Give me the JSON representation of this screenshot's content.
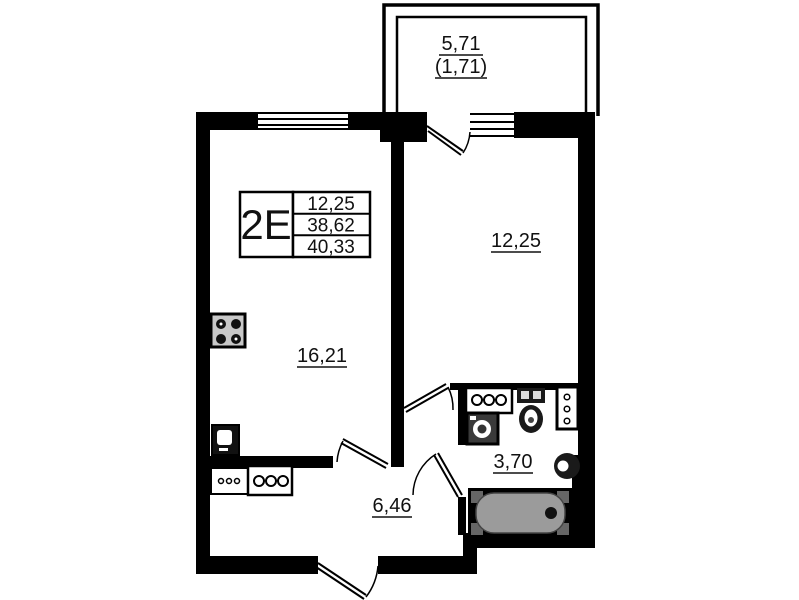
{
  "plan": {
    "unit": {
      "type_label": "2E",
      "area_rows": [
        "12,25",
        "38,62",
        "40,33"
      ]
    },
    "balcony": {
      "area_total": "5,71",
      "area_counted": "(1,71)"
    },
    "rooms": {
      "room_right": "12,25",
      "room_left": "16,21",
      "hallway": "6,46",
      "bathroom": "3,70"
    },
    "colors": {
      "wall": "#000000",
      "background": "#ffffff",
      "tub_fill": "#9b9b9b",
      "fixture_gray": "#c8c8c8"
    }
  }
}
